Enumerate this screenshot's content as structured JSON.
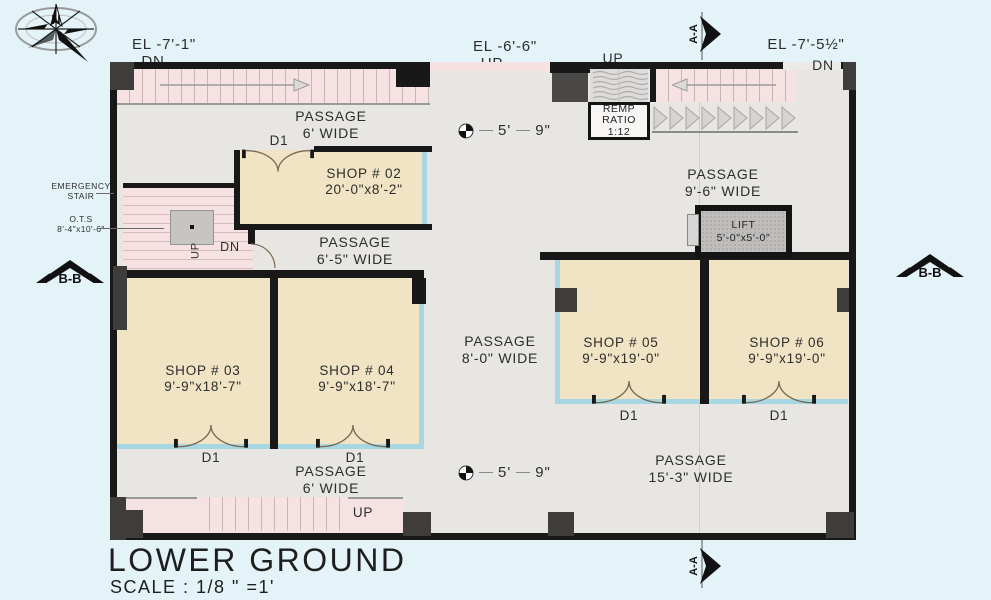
{
  "page": {
    "title": "LOWER GROUND",
    "scale": "SCALE  : 1/8 \" =1'"
  },
  "compass": {
    "north": "N"
  },
  "markers": {
    "section_aa": "A-A",
    "section_bb": "B-B",
    "dim_feet": "5'",
    "dim_inches": "9\""
  },
  "elevations": {
    "top_left": "EL -7'-1\"",
    "top_left_dir": "DN",
    "top_center": "EL -6'-6\"",
    "top_center_dir": "UP",
    "top_right": "EL -7'-5½\"",
    "top_right_dir": "DN",
    "ramp_dir": "UP",
    "bottom_stair_dir": "UP"
  },
  "ramp": {
    "l1": "REMP",
    "l2": "RATIO",
    "l3": "1:12"
  },
  "emergency_stair": {
    "l1": "EMERGENCY",
    "l2": "STAIR",
    "ots1": "O.T.S",
    "ots2": "8'-4\"x10'-6\"",
    "up": "UP",
    "dn": "DN"
  },
  "lift": {
    "l1": "LIFT",
    "l2": "5'-0\"x5'-0\""
  },
  "door_label": "D1",
  "shops": {
    "s02": {
      "name": "SHOP # 02",
      "size": "20'-0\"x8'-2\""
    },
    "s03": {
      "name": "SHOP # 03",
      "size": "9'-9\"x18'-7\""
    },
    "s04": {
      "name": "SHOP # 04",
      "size": "9'-9\"x18'-7\""
    },
    "s05": {
      "name": "SHOP # 05",
      "size": "9'-9\"x19'-0\""
    },
    "s06": {
      "name": "SHOP # 06",
      "size": "9'-9\"x19'-0\""
    }
  },
  "passages": {
    "top": {
      "l1": "PASSAGE",
      "l2": "6' WIDE"
    },
    "mid": {
      "l1": "PASSAGE",
      "l2": "6'-5\" WIDE"
    },
    "central": {
      "l1": "PASSAGE",
      "l2": "8'-0\" WIDE"
    },
    "right": {
      "l1": "PASSAGE",
      "l2": "9'-6\" WIDE"
    },
    "bottom_right": {
      "l1": "PASSAGE",
      "l2": "15'-3\" WIDE"
    },
    "bottom": {
      "l1": "PASSAGE",
      "l2": "6' WIDE"
    }
  },
  "colors": {
    "background": "#e3f3f8",
    "wall": "#181818",
    "shop": "#f0e4c4",
    "passage": "#e8e6e3",
    "stair": "#f6e2e2",
    "storefront": "#a6d7e2",
    "column": "#3f3d3b",
    "lift": "#c0bebc"
  }
}
